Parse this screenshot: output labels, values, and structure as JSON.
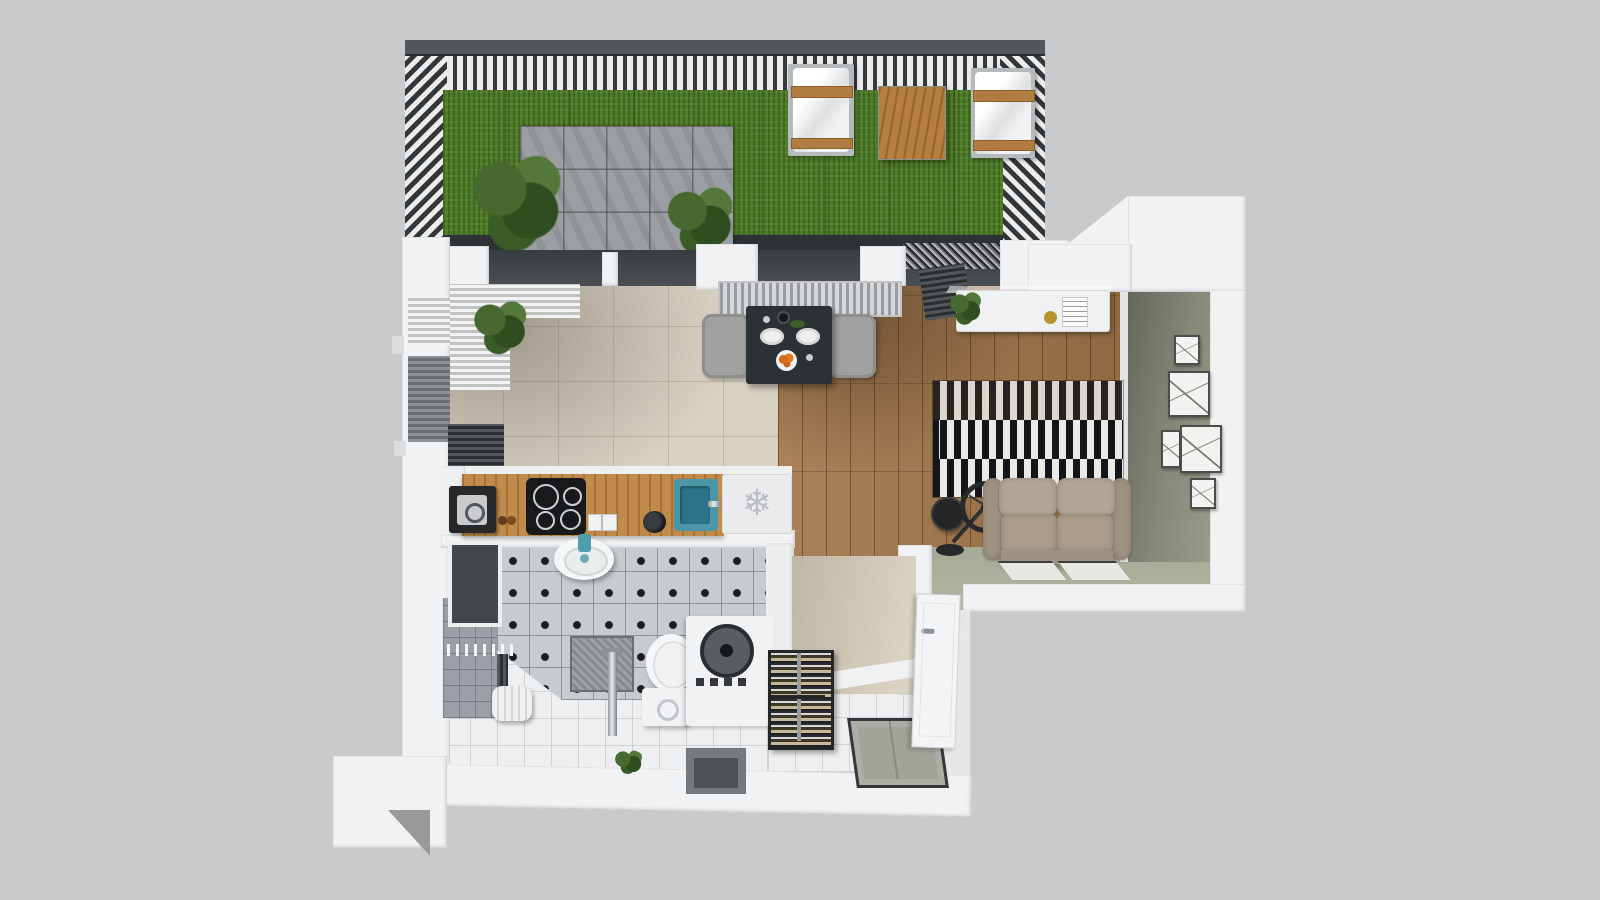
{
  "scene": {
    "kind": "3d-floor-plan-render",
    "subject": "top-down 3D render of a studio apartment with a roof terrace",
    "view": "bird's-eye cutaway, no visible text labels"
  },
  "palette": {
    "background": "#c9cacb",
    "wall_white": "#f1f2f3",
    "pergola_dark": "#3a3d40",
    "grass_green": "#4f7c28",
    "patio_gray": "#9b9fa3",
    "floor_beige": "#d9d1c2",
    "floor_wood": "#a3774a",
    "floor_sage": "#abaf9c",
    "wall_sage": "#7d8272",
    "tile_white": "#edeff0",
    "tile_dotted": "#c7cbce",
    "counter_oak": "#c08a4a",
    "sink_teal": "#4f9dae",
    "sofa_taupe": "#a89a86",
    "rug_black": "#141519",
    "rug_white": "#e9e9e6",
    "furniture_wood": "#b5803f",
    "glass_dark": "#42474b"
  },
  "icons": {
    "fridge_snowflake": "❄"
  },
  "inventory": {
    "terrace": [
      "pergola-slat-fence",
      "artificial-grass",
      "tile-patio",
      "potted-shrub",
      "palm-plant",
      "two-lounge-chairs",
      "wooden-side-table",
      "gravel-strip"
    ],
    "kitchen": [
      "oak-counter",
      "coffee-machine",
      "induction-cooktop",
      "storage-jars",
      "kettle",
      "teal-sink",
      "fridge-top-with-snowflake"
    ],
    "dining": [
      "window-radiator",
      "dark-square-table",
      "two-upholstered-chairs",
      "plates-and-food"
    ],
    "living": [
      "wood-plank-floor",
      "black-white-striped-rug",
      "taupe-two-seat-sofa",
      "spoked-ring-floor-lamp",
      "black-round-side-table",
      "two-floor-mats",
      "white-sideboard-with-plant",
      "radiator",
      "five-gallery-frames",
      "sage-accent-wall"
    ],
    "bathroom": [
      "dot-pattern-tile-floor",
      "white-tile-floor",
      "round-basin-teal-faucet",
      "shower-column",
      "shower-tray",
      "toilet-with-cistern",
      "top-load-washing-machine",
      "laundry-bin",
      "towel-hooks",
      "vertical-radiator",
      "dark-wall-niche",
      "floor-plant"
    ],
    "hallway": [
      "beige-wall",
      "shoe-rack-with-shoes",
      "gray-doormat",
      "white-entrance-door"
    ]
  }
}
